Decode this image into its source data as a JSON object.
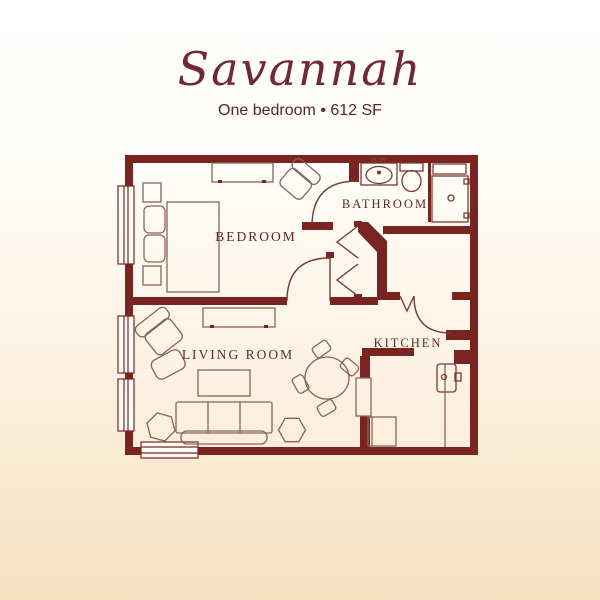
{
  "title": "Savannah",
  "subtitle": "One bedroom • 612 SF",
  "floor_plan": {
    "labels": {
      "bedroom": "BEDROOM",
      "bathroom": "BATHROOM",
      "living_room": "LIVING ROOM",
      "kitchen": "KITCHEN"
    },
    "furniture": [
      "bed",
      "nightstands",
      "dresser",
      "bedroom-chair",
      "armchair",
      "ottoman",
      "console-table",
      "coffee-table",
      "sofa",
      "side-tables",
      "dining-table",
      "dining-chairs",
      "range",
      "kitchen-sink",
      "kitchen-counter",
      "vanity-sink",
      "toilet",
      "shower"
    ]
  },
  "colors": {
    "wall": "#7a2422",
    "door_line": "#7b3a30",
    "furniture_line": "#8a6458",
    "title_text": "#722637",
    "label_text": "#5e2a1f",
    "background_top": "#ffffff",
    "background_bottom": "#f7e0c0"
  }
}
